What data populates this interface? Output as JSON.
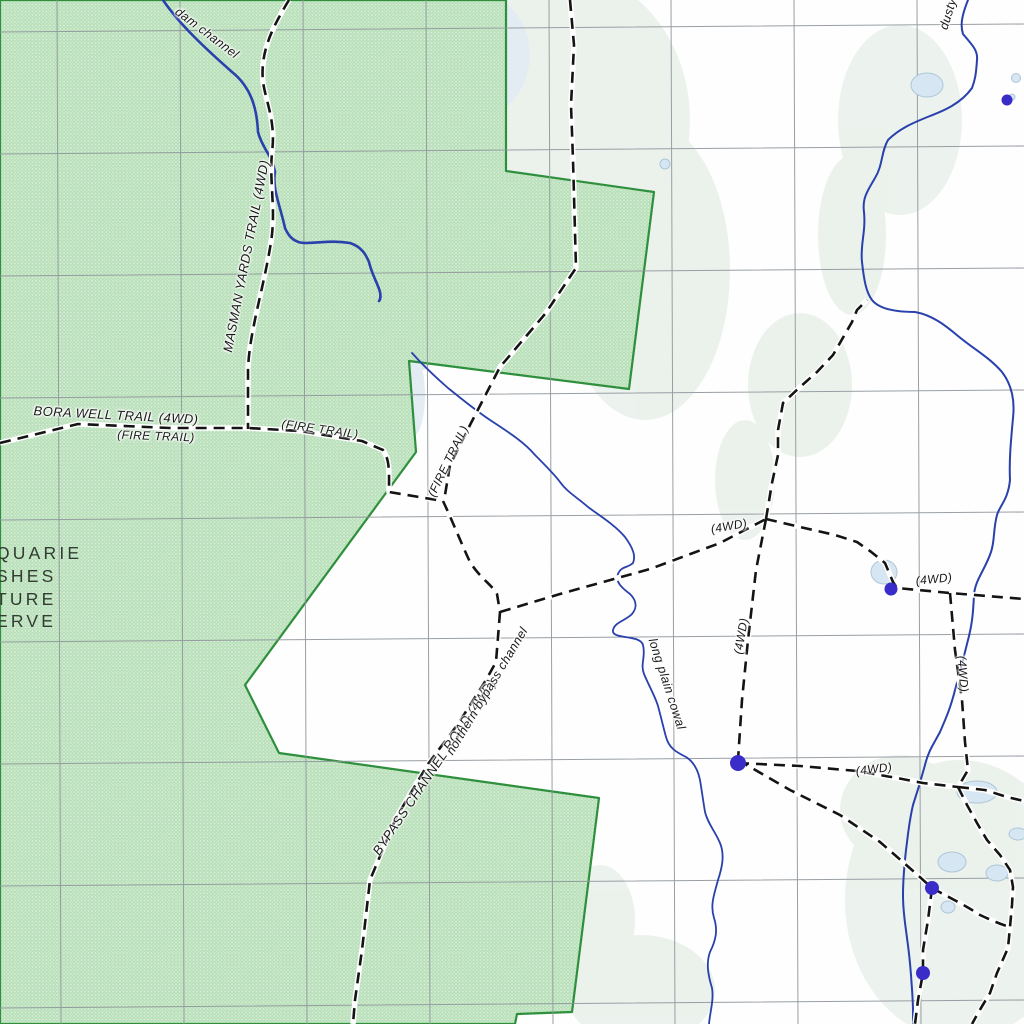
{
  "map": {
    "reserve_name_fragments": [
      "QUARIE",
      "SHES",
      "TURE",
      "ERVE"
    ],
    "labels": {
      "dam_channel": "dam channel",
      "masman_yards_trail": "MASMAN YARDS TRAIL (4WD)",
      "bora_well_trail": "BORA WELL TRAIL (4WD)",
      "fire_trail_1": "(FIRE TRAIL)",
      "fire_trail_2": "(FIRE TRAIL)",
      "fire_trail_3": "(FIRE TRAIL)",
      "bypass_channel_road": "BYPASS CHANNEL ROAD (4WD)",
      "northern_bypass_channel": "northern bypass channel",
      "long_plain_cowal": "long plain cowal",
      "dusty_fragment": "dusty",
      "fourwd_a": "(4WD)",
      "fourwd_b": "(4WD)",
      "fourwd_c": "(4WD)",
      "fourwd_d": "(4WD)",
      "fourwd_e": "(4WD)"
    },
    "colors": {
      "map_bg": "#fdfefd",
      "reserve_fill": "#b7dfb8",
      "reserve_border": "#2e8f3c",
      "grid": "#8f959c",
      "water": "#2a40ad",
      "water_point": "#3a2cc9",
      "trail": "#141414",
      "trail_casing": "#ffffff",
      "label": "#1a1a1a",
      "reserve_label": "#323c32",
      "pond_fill": "#d6e6f2",
      "pond_stroke": "#aec6d8",
      "wash_green": "#e9f0ea",
      "wash_blue": "#dfeaf2"
    }
  }
}
